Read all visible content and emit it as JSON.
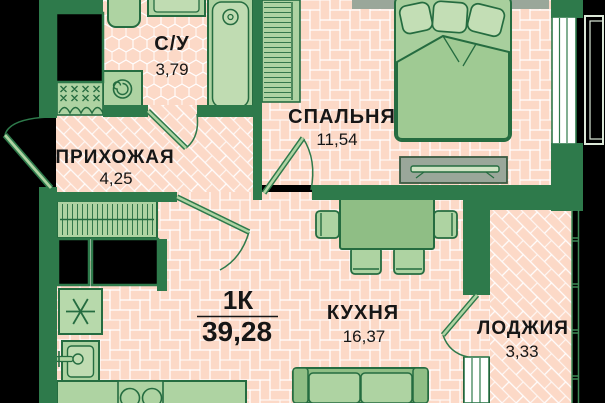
{
  "plan": {
    "summary": {
      "type": "1К",
      "area": "39,28"
    },
    "rooms": [
      {
        "id": "bathroom",
        "name": "С/У",
        "area": "3,79"
      },
      {
        "id": "hallway",
        "name": "ПРИХОЖАЯ",
        "area": "4,25"
      },
      {
        "id": "bedroom",
        "name": "СПАЛЬНЯ",
        "area": "11,54"
      },
      {
        "id": "kitchen",
        "name": "КУХНЯ",
        "area": "16,37"
      },
      {
        "id": "loggia",
        "name": "ЛОДЖИЯ",
        "area": "3,33"
      }
    ],
    "colors": {
      "wall": "#2e7a4b",
      "floor": "#fcd9c7",
      "pattern_line": "#ffffff",
      "furniture_light": "#aed3a2",
      "furniture_lighter": "#c0dcb2",
      "furniture_mid": "#8fbe85",
      "outline": "#256c40",
      "gray_element": "#9aa79a",
      "window_white": "#ffffff",
      "background": "#000000",
      "text": "#161616"
    },
    "fixtures": [
      "toilet",
      "wash-basin",
      "bathtub",
      "washing-machine",
      "wardrobe",
      "hall-closet",
      "ventilation-shaft",
      "refrigerator",
      "kitchen-sink",
      "stove",
      "kitchen-counter",
      "dining-table",
      "chair",
      "sofa",
      "double-bed",
      "tv-stand",
      "window",
      "loggia-glazing",
      "balcony-railing",
      "door"
    ]
  }
}
